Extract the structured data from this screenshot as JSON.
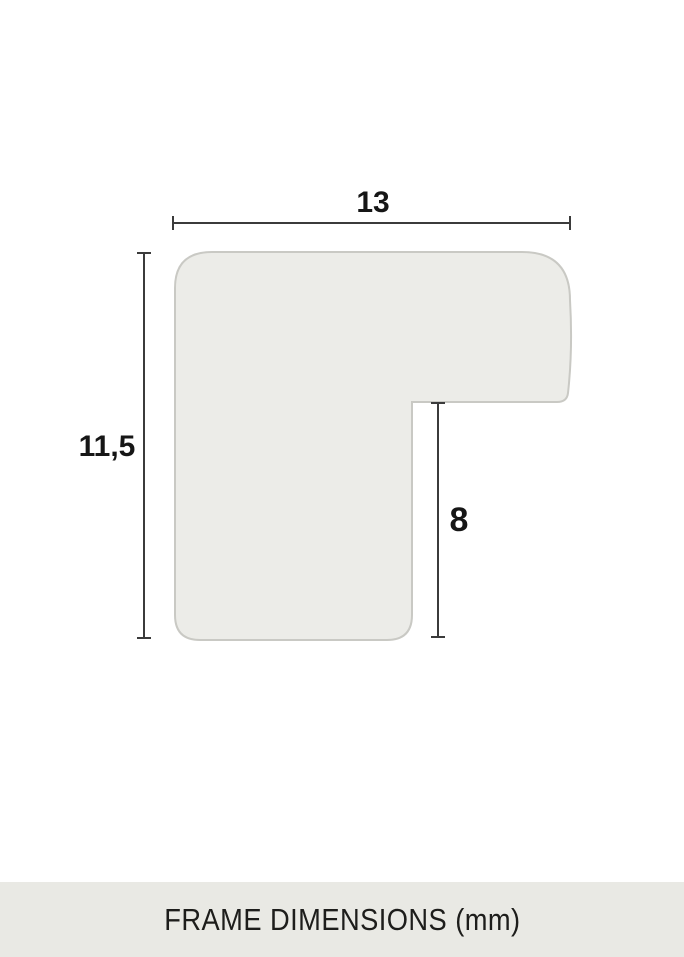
{
  "diagram": {
    "type": "frame-profile-cross-section",
    "labels": {
      "width": "13",
      "height": "11,5",
      "inner_height": "8"
    },
    "values_mm": {
      "width": 13,
      "height": 11.5,
      "inner_height": 8
    },
    "unit": "mm"
  },
  "footer": {
    "title": "FRAME DIMENSIONS (mm)"
  },
  "colors": {
    "background": "#FFFFFF",
    "shape_fill": "#ECECE8",
    "shape_border": "#C9C9C4",
    "dimension_line": "#3B3B3B",
    "label_text": "#161616",
    "footer_background": "#E9E9E4",
    "footer_text": "#1D1D1B"
  }
}
